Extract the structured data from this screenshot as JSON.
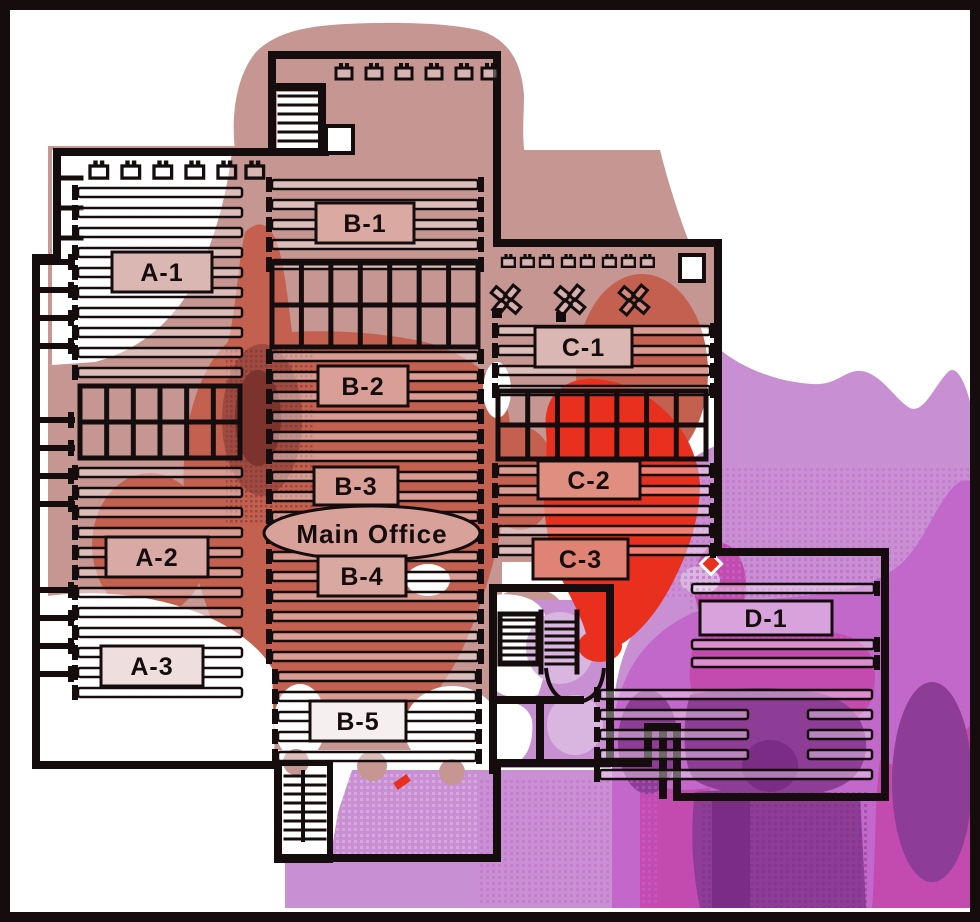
{
  "floorplan": {
    "main_office": {
      "label": "Main Office",
      "fill": "#d8a29b"
    },
    "zones": [
      {
        "id": "A-1",
        "label": "A-1",
        "fill": "#dbb7b3"
      },
      {
        "id": "A-2",
        "label": "A-2",
        "fill": "#d9aaa5"
      },
      {
        "id": "A-3",
        "label": "A-3",
        "fill": "#eedede"
      },
      {
        "id": "B-1",
        "label": "B-1",
        "fill": "#d9a9a2"
      },
      {
        "id": "B-2",
        "label": "B-2",
        "fill": "#d99f97"
      },
      {
        "id": "B-3",
        "label": "B-3",
        "fill": "#d9a098"
      },
      {
        "id": "B-4",
        "label": "B-4",
        "fill": "#d9a8a1"
      },
      {
        "id": "B-5",
        "label": "B-5",
        "fill": "#f5f0ef"
      },
      {
        "id": "C-1",
        "label": "C-1",
        "fill": "#dbb7b3"
      },
      {
        "id": "C-2",
        "label": "C-2",
        "fill": "#df8e80"
      },
      {
        "id": "C-3",
        "label": "C-3",
        "fill": "#e08274"
      },
      {
        "id": "D-1",
        "label": "D-1",
        "fill": "#d8a3dd"
      }
    ]
  },
  "heatmap": {
    "palette": {
      "white": "#ffffff",
      "rose": "#c69693",
      "salmon": "#c4604f",
      "salmon_dark": "#9e4a40",
      "maroon": "#7c332e",
      "red": "#e92f1d",
      "lavender": "#c98fd3",
      "lavender_pale": "#d9b6df",
      "orchid": "#c168ca",
      "magenta": "#c34aae",
      "purple_dark": "#8d3d95",
      "violet_deep": "#7b2c85",
      "ink": "#150d0d"
    }
  }
}
